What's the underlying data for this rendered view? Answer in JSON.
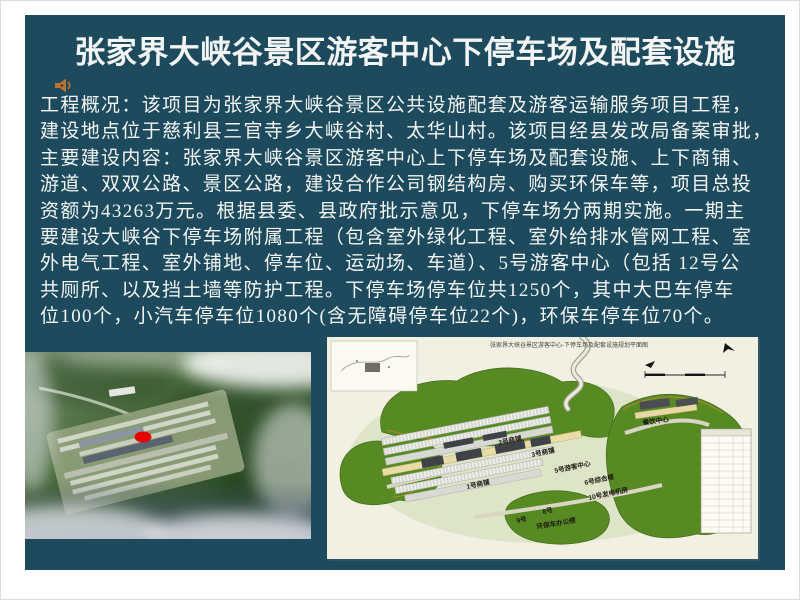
{
  "slide": {
    "title": "张家界大峡谷景区游客中心下停车场及配套设施",
    "body_lines": [
      "工程概况：该项目为张家界大峡谷景区公共设施配套及游客运输服务项目工程，",
      "建设地点位于慈利县三官寺乡大峡谷村、太华山村。该项目经县发改局备案审批，",
      "主要建设内容：张家界大峡谷景区游客中心上下停车场及配套设施、上下商铺、",
      "游道、双双公路、景区公路，建设合作公司钢结构房、购买环保车等，项目总投",
      "资额为43263万元。根据县委、县政府批示意见，下停车场分两期实施。一期主",
      "要建设大峡谷下停车场附属工程（包含室外绿化工程、室外给排水管网工程、室",
      "外电气工程、室外铺地、停车位、运动场、车道）、5号游客中心（包括 12号公",
      "共厕所、以及挡土墙等防护工程。下停车场停车位共1250个，其中大巴车停车",
      "位100个，小汽车停车位1080个(含无障碍停车位22个)，环保车停车位70个。"
    ],
    "icons": {
      "speaker": "speaker-icon"
    },
    "colors": {
      "slide_background": "#1d4a5c",
      "page_background": "#ffffff",
      "text": "#f2f5f4",
      "marker_red": "#e60000",
      "speaker_icon_orange": "#b87333",
      "plan_paper": "#f1f0e2",
      "forest_green": "#588a24"
    }
  },
  "plan": {
    "title": "张家界大峡谷景区游客中心-下停车场及配套设施规划平面图",
    "labels": [
      "餐饮中心",
      "2号商铺",
      "3号商铺",
      "1号商铺",
      "5号游客中心",
      "6号综合楼",
      "10号发电机房",
      "8号",
      "9号",
      "环保车办公楼"
    ]
  }
}
